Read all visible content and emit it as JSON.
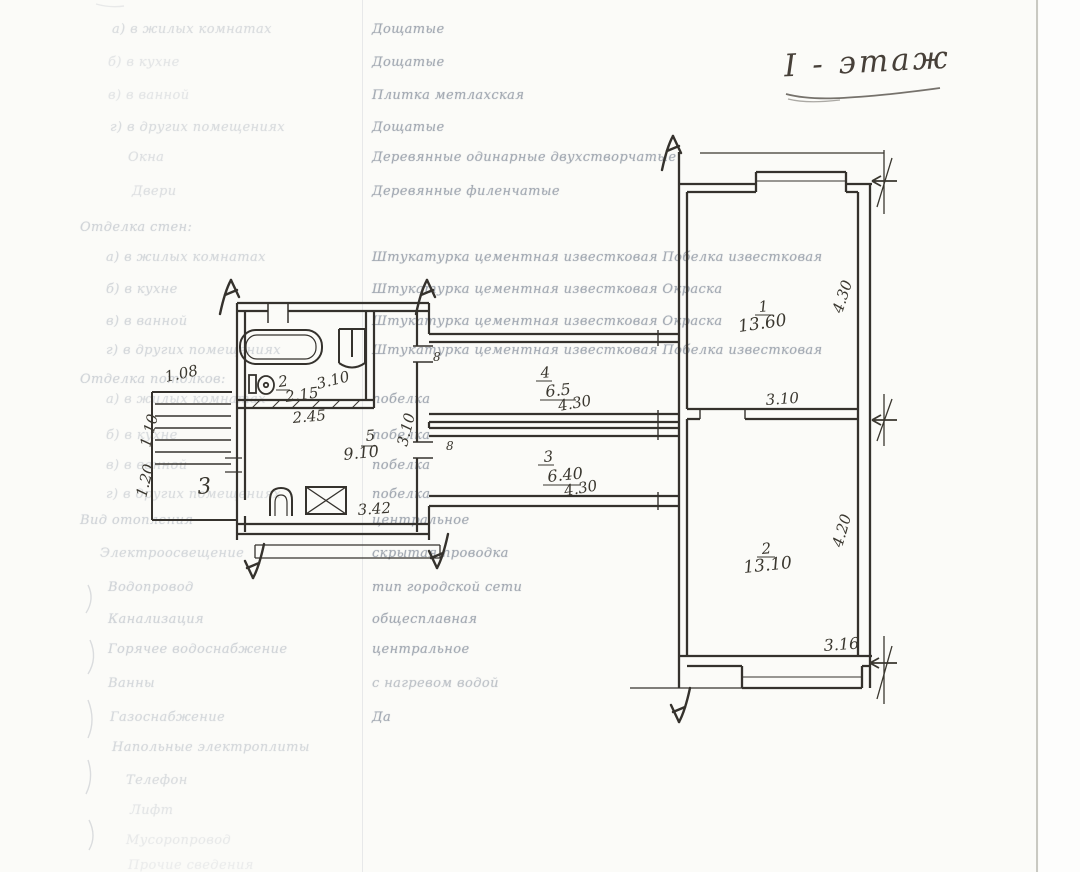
{
  "page": {
    "title": "I - этаж"
  },
  "colors": {
    "paper": "#fbfbf8",
    "ink": "#35322d",
    "typed_text": "#8e96a2",
    "faint_label": "#a7aeb9"
  },
  "spec": {
    "rows": [
      {
        "label": "а) в жилых комнатах",
        "value": "Дощатые"
      },
      {
        "label": "б) в кухне",
        "value": "Дощатые"
      },
      {
        "label": "в) в ванной",
        "value": "Плитка метлахская"
      },
      {
        "label": "г) в других помещениях",
        "value": "Дощатые"
      },
      {
        "label": "Окна",
        "value": "Деревянные одинарные двухстворчатые"
      },
      {
        "label": "Двери",
        "value": "Деревянные филенчатые"
      },
      {
        "label": "Отделка стен:",
        "value": ""
      },
      {
        "label": "а) в жилых комнатах",
        "value": "Штукатурка цементная известковая Побелка известковая"
      },
      {
        "label": "б) в кухне",
        "value": "Штукатурка цементная известковая Окраска"
      },
      {
        "label": "в) в ванной",
        "value": "Штукатурка цементная известковая Окраска"
      },
      {
        "label": "г) в других помещениях",
        "value": "Штукатурка цементная известковая Побелка известковая"
      },
      {
        "label": "Отделка потолков:",
        "value": ""
      },
      {
        "label": "а) в жилых комнатах",
        "value": "побелка"
      },
      {
        "label": "б) в кухне",
        "value": "побелка"
      },
      {
        "label": "в) в ванной",
        "value": "побелка"
      },
      {
        "label": "г) в других помещениях",
        "value": "побелка"
      },
      {
        "label": "Вид отопления",
        "value": "центральное"
      },
      {
        "label": "Электроосвещение",
        "value": "скрытая проводка"
      },
      {
        "label": "Водопровод",
        "value": "тип городской сети"
      },
      {
        "label": "Канализация",
        "value": "общесплавная"
      },
      {
        "label": "Горячее водоснабжение",
        "value": "центральное"
      },
      {
        "label": "Ванны",
        "value": "с нагревом водой"
      },
      {
        "label": "Газоснабжение",
        "value": "Да"
      },
      {
        "label": "Напольные электроплиты",
        "value": ""
      },
      {
        "label": "Телефон",
        "value": ""
      },
      {
        "label": "Лифт",
        "value": ""
      },
      {
        "label": "Мусоропровод",
        "value": ""
      },
      {
        "label": "Прочие сведения",
        "value": ""
      }
    ]
  },
  "plan": {
    "floor_label": "I - этаж",
    "labels": {
      "stairs_width": "1.08",
      "stairs_d1": "1.10",
      "stairs_d2": "1.20",
      "stairs_num": "3",
      "wc_num": "2",
      "wc_area": "2.15",
      "wc_dim": "3.10",
      "bath_width": "2.45",
      "kitchen_num": "5",
      "kitchen_area": "9.10",
      "kitchen_width": "3.42",
      "kitchen_depth": "3.10",
      "hall4_num": "4",
      "hall4_area": "6.5",
      "hall4_len": "4.30",
      "hall3_num": "3",
      "hall3_area": "6.40",
      "hall3_len": "4.30",
      "door_a": "8",
      "door_b": "8",
      "room1_num": "1",
      "room1_area": "13.60",
      "room1_depth": "4.30",
      "room1_width": "3.10",
      "room2_num": "2",
      "room2_area": "13.10",
      "room2_depth": "4.20",
      "room2_width": "3.16"
    }
  }
}
